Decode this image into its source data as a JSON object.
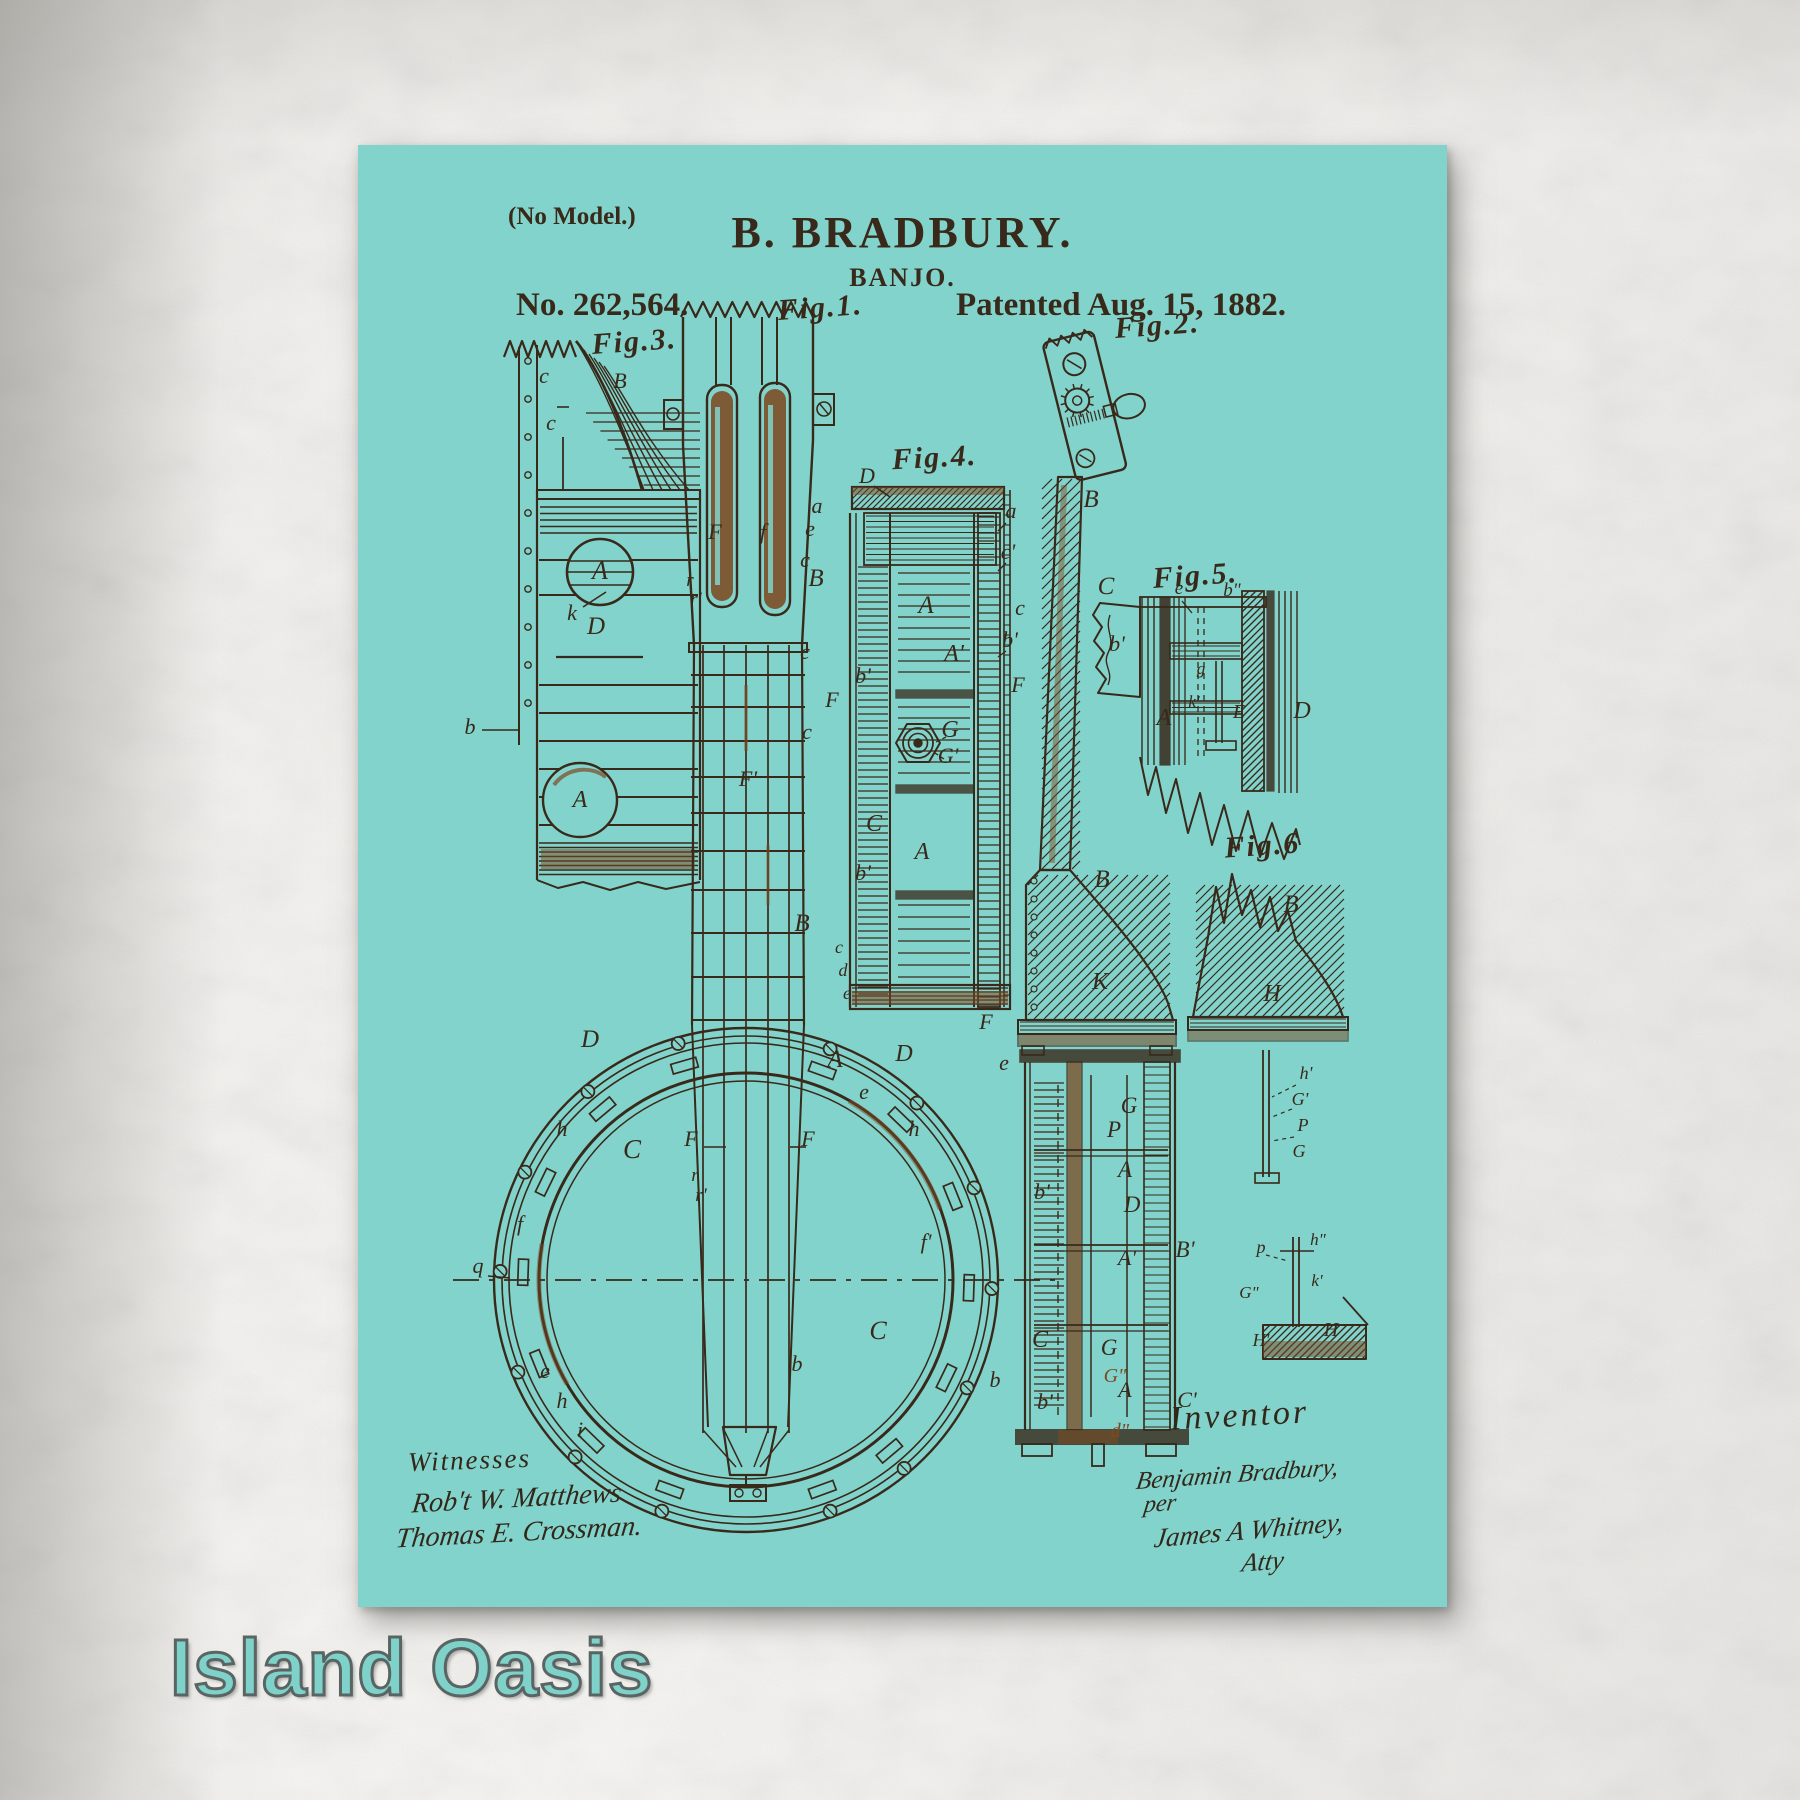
{
  "artwork": {
    "brand": "Island Oasis",
    "patent": {
      "no_model": "(No Model.)",
      "inventor_name": "B. BRADBURY.",
      "subject": "BANJO.",
      "number": "No. 262,564.",
      "patented": "Patented Aug. 15, 1882.",
      "witnesses_heading": "Witnesses",
      "witness_signatures": [
        "Rob't W. Matthews",
        "Thomas E. Crossman."
      ],
      "inventor_heading": "Inventor",
      "inventor_signature": [
        "Benjamin Bradbury,",
        "per",
        "James A Whitney,",
        "Atty"
      ]
    },
    "colors": {
      "poster_teal": "#82d3cb",
      "ink": "#38291a",
      "rust": "#7c4a21",
      "brand_text": "#7fd2ca",
      "paper": "#f2f1ee"
    },
    "figure_labels": [
      {
        "t": "Fig.3.",
        "x": 277,
        "y": 206,
        "r": -4
      },
      {
        "t": "Fig.1.",
        "x": 463,
        "y": 172,
        "r": -4
      },
      {
        "t": "Fig.2.",
        "x": 800,
        "y": 190,
        "r": -4
      },
      {
        "t": "Fig.4.",
        "x": 577,
        "y": 322,
        "r": -3
      },
      {
        "t": "Fig.5.",
        "x": 838,
        "y": 440,
        "r": -4
      },
      {
        "t": "Fig.6",
        "x": 905,
        "y": 710,
        "r": -4
      }
    ],
    "part_labels": [
      {
        "t": "c",
        "x": 186,
        "y": 238
      },
      {
        "t": "c",
        "x": 193,
        "y": 285
      },
      {
        "t": "B",
        "x": 262,
        "y": 243
      },
      {
        "t": "A",
        "x": 242,
        "y": 434,
        "s": 26
      },
      {
        "t": "k",
        "x": 214,
        "y": 475
      },
      {
        "t": "D",
        "x": 238,
        "y": 489,
        "s": 25
      },
      {
        "t": "A",
        "x": 222,
        "y": 662,
        "s": 24
      },
      {
        "t": "b",
        "x": 112,
        "y": 589
      },
      {
        "t": "a",
        "x": 459,
        "y": 368
      },
      {
        "t": "e",
        "x": 452,
        "y": 391
      },
      {
        "t": "c",
        "x": 447,
        "y": 422
      },
      {
        "t": "B",
        "x": 458,
        "y": 441,
        "s": 25
      },
      {
        "t": "F",
        "x": 357,
        "y": 394
      },
      {
        "t": "f",
        "x": 405,
        "y": 394
      },
      {
        "t": "r",
        "x": 332,
        "y": 441,
        "s": 19
      },
      {
        "t": "r'",
        "x": 338,
        "y": 460,
        "s": 19
      },
      {
        "t": "c",
        "x": 447,
        "y": 514
      },
      {
        "t": "c",
        "x": 449,
        "y": 594
      },
      {
        "t": "F'",
        "x": 390,
        "y": 641
      },
      {
        "t": "B",
        "x": 444,
        "y": 786,
        "s": 25
      },
      {
        "t": "D",
        "x": 232,
        "y": 902,
        "s": 25
      },
      {
        "t": "A",
        "x": 477,
        "y": 922,
        "s": 25
      },
      {
        "t": "C",
        "x": 274,
        "y": 1013,
        "s": 27
      },
      {
        "t": "F",
        "x": 333,
        "y": 1001
      },
      {
        "t": "F",
        "x": 450,
        "y": 1001
      },
      {
        "t": "r",
        "x": 337,
        "y": 1036,
        "s": 19
      },
      {
        "t": "r'",
        "x": 343,
        "y": 1056,
        "s": 19
      },
      {
        "t": "h",
        "x": 204,
        "y": 991
      },
      {
        "t": "f",
        "x": 162,
        "y": 1086
      },
      {
        "t": "q",
        "x": 120,
        "y": 1128
      },
      {
        "t": "e",
        "x": 187,
        "y": 1233
      },
      {
        "t": "h",
        "x": 204,
        "y": 1263
      },
      {
        "t": "i",
        "x": 222,
        "y": 1292
      },
      {
        "t": "b",
        "x": 439,
        "y": 1226
      },
      {
        "t": "C",
        "x": 520,
        "y": 1194,
        "s": 26
      },
      {
        "t": "D",
        "x": 546,
        "y": 916,
        "s": 24
      },
      {
        "t": "e",
        "x": 506,
        "y": 954
      },
      {
        "t": "h",
        "x": 556,
        "y": 991
      },
      {
        "t": "f'",
        "x": 568,
        "y": 1104
      },
      {
        "t": "D",
        "x": 509,
        "y": 338
      },
      {
        "t": "A",
        "x": 568,
        "y": 468,
        "s": 25
      },
      {
        "t": "A'",
        "x": 596,
        "y": 516,
        "s": 24
      },
      {
        "t": "G",
        "x": 592,
        "y": 592,
        "s": 24
      },
      {
        "t": "G'",
        "x": 590,
        "y": 618,
        "s": 22
      },
      {
        "t": "C",
        "x": 516,
        "y": 686,
        "s": 24
      },
      {
        "t": "A",
        "x": 564,
        "y": 714,
        "s": 24
      },
      {
        "t": "b'",
        "x": 505,
        "y": 538
      },
      {
        "t": "F",
        "x": 474,
        "y": 562
      },
      {
        "t": "a",
        "x": 653,
        "y": 373
      },
      {
        "t": "c'",
        "x": 650,
        "y": 414
      },
      {
        "t": "c",
        "x": 662,
        "y": 470
      },
      {
        "t": "b'",
        "x": 652,
        "y": 502
      },
      {
        "t": "F",
        "x": 660,
        "y": 547
      },
      {
        "t": "b'",
        "x": 505,
        "y": 735
      },
      {
        "t": "c",
        "x": 481,
        "y": 808,
        "s": 18
      },
      {
        "t": "d",
        "x": 485,
        "y": 831,
        "s": 18
      },
      {
        "t": "e",
        "x": 489,
        "y": 854,
        "s": 18
      },
      {
        "t": "B",
        "x": 733,
        "y": 362,
        "s": 25
      },
      {
        "t": "B",
        "x": 744,
        "y": 742,
        "s": 25
      },
      {
        "t": "K",
        "x": 742,
        "y": 844,
        "s": 24
      },
      {
        "t": "F",
        "x": 628,
        "y": 884
      },
      {
        "t": "e",
        "x": 646,
        "y": 925
      },
      {
        "t": "b'",
        "x": 684,
        "y": 1054
      },
      {
        "t": "G",
        "x": 771,
        "y": 968,
        "s": 23
      },
      {
        "t": "P",
        "x": 756,
        "y": 992,
        "s": 23
      },
      {
        "t": "A",
        "x": 767,
        "y": 1032,
        "s": 23
      },
      {
        "t": "D",
        "x": 774,
        "y": 1067,
        "s": 23
      },
      {
        "t": "A'",
        "x": 769,
        "y": 1120,
        "s": 22
      },
      {
        "t": "B'",
        "x": 827,
        "y": 1112,
        "s": 23
      },
      {
        "t": "C",
        "x": 682,
        "y": 1202,
        "s": 24
      },
      {
        "t": "G",
        "x": 751,
        "y": 1210,
        "s": 23
      },
      {
        "t": "b",
        "x": 637,
        "y": 1242
      },
      {
        "t": "b'",
        "x": 687,
        "y": 1264
      },
      {
        "t": "A",
        "x": 767,
        "y": 1252,
        "s": 22
      },
      {
        "t": "C'",
        "x": 829,
        "y": 1262,
        "s": 22
      },
      {
        "t": "G\"",
        "x": 757,
        "y": 1237,
        "s": 20,
        "c": "rust"
      },
      {
        "t": "d\"",
        "x": 762,
        "y": 1292,
        "s": 20,
        "c": "rust"
      },
      {
        "t": "C",
        "x": 748,
        "y": 449,
        "s": 25
      },
      {
        "t": "b'",
        "x": 759,
        "y": 506
      },
      {
        "t": "e",
        "x": 821,
        "y": 449,
        "s": 19
      },
      {
        "t": "b\"",
        "x": 874,
        "y": 451,
        "s": 19
      },
      {
        "t": "A",
        "x": 806,
        "y": 580,
        "s": 24
      },
      {
        "t": "E",
        "x": 881,
        "y": 573,
        "s": 20
      },
      {
        "t": "D",
        "x": 944,
        "y": 573,
        "s": 24
      },
      {
        "t": "k'",
        "x": 836,
        "y": 562,
        "s": 17
      },
      {
        "t": "g",
        "x": 843,
        "y": 529,
        "s": 17
      },
      {
        "t": "B",
        "x": 933,
        "y": 767,
        "s": 25
      },
      {
        "t": "H",
        "x": 914,
        "y": 856,
        "s": 24
      },
      {
        "t": "h'",
        "x": 948,
        "y": 934,
        "s": 18
      },
      {
        "t": "G'",
        "x": 942,
        "y": 960,
        "s": 18
      },
      {
        "t": "P",
        "x": 945,
        "y": 986,
        "s": 18
      },
      {
        "t": "G",
        "x": 941,
        "y": 1012,
        "s": 18
      },
      {
        "t": "p",
        "x": 903,
        "y": 1108,
        "s": 18
      },
      {
        "t": "h\"",
        "x": 960,
        "y": 1100,
        "s": 17
      },
      {
        "t": "k'",
        "x": 959,
        "y": 1141,
        "s": 17
      },
      {
        "t": "G\"",
        "x": 891,
        "y": 1153,
        "s": 17
      },
      {
        "t": "H'",
        "x": 903,
        "y": 1201,
        "s": 18
      },
      {
        "t": "H",
        "x": 973,
        "y": 1191,
        "s": 20
      }
    ]
  }
}
